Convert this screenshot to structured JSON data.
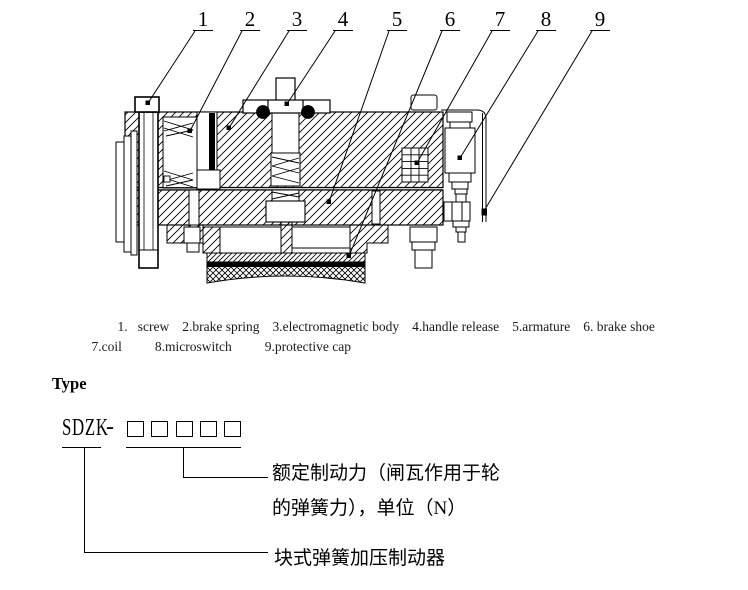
{
  "figure": {
    "callouts": [
      "1",
      "2",
      "3",
      "4",
      "5",
      "6",
      "7",
      "8",
      "9"
    ],
    "parts": {
      "1": "screw",
      "2": "brake spring",
      "3": "electromagnetic body",
      "4": "handle release",
      "5": "armature",
      "6": "brake shoe",
      "7": "coil",
      "8": "microswitch",
      "9": "protective cap"
    }
  },
  "legend": {
    "line1": [
      "1.   screw",
      "2.brake spring",
      "3.electromagnetic body",
      "4.handle release",
      "5.armature",
      "6. brake shoe"
    ],
    "line2": [
      "7.coil",
      "8.microswitch",
      "9.protective cap"
    ]
  },
  "type_section": {
    "heading": "Type",
    "model_prefix": "SDZK",
    "separator": "-",
    "digit_box_count": 5,
    "annotations": {
      "rated_force_line1": "额定制动力（闸瓦作用于轮",
      "rated_force_line2": "的弹簧力），单位（N）",
      "brake_type": "块式弹簧加压制动器"
    }
  },
  "colors": {
    "ink": "#000000",
    "paper": "#ffffff"
  }
}
